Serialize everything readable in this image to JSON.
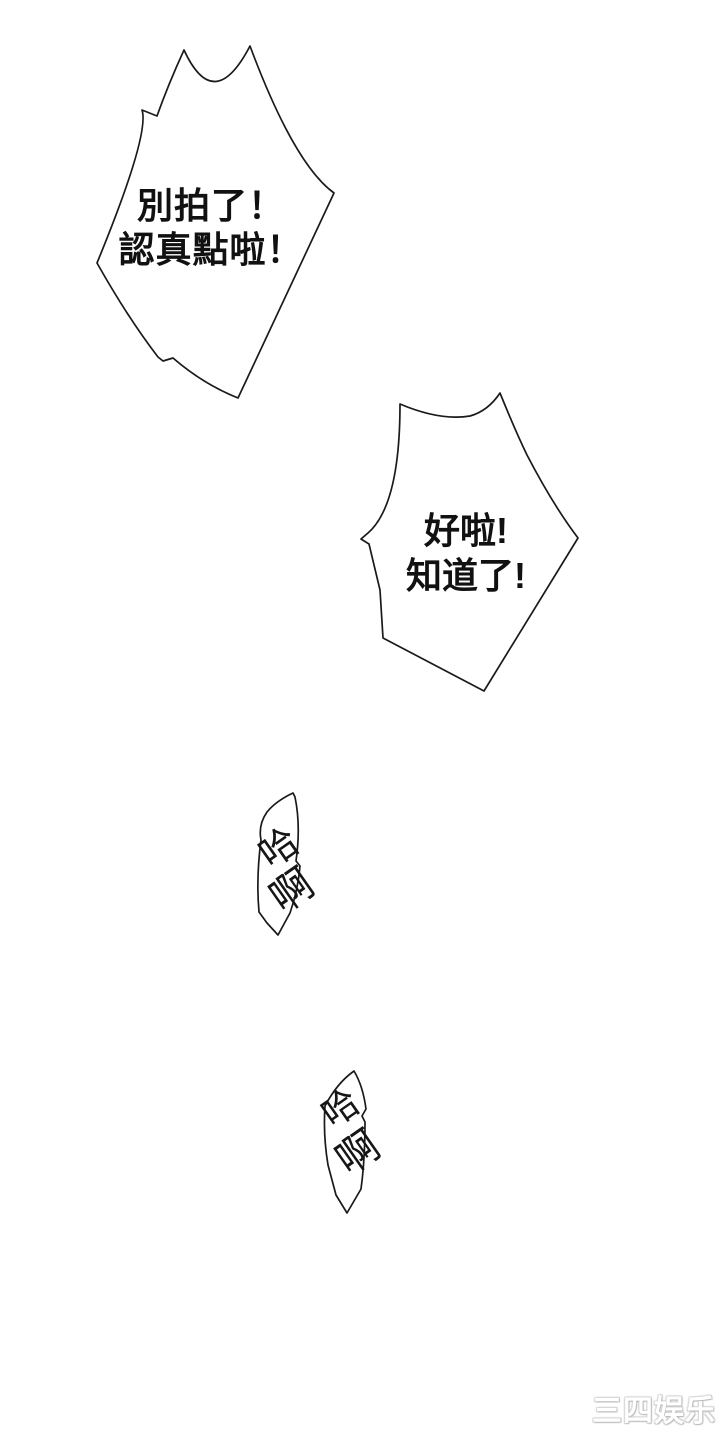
{
  "colors": {
    "background": "#ffffff",
    "ink": "#1a1a1a",
    "watermark_fill": "#ffffff",
    "watermark_shadow": "#c0c0c0"
  },
  "bubbles": {
    "shout": {
      "line1": "別拍了！",
      "line2": "認真點啦！"
    },
    "reply": {
      "line1": "好啦!",
      "line2": "知道了!"
    },
    "sfx1": {
      "char1": "哈",
      "char2": "啊"
    },
    "sfx2": {
      "char1": "哈",
      "char2": "啊"
    }
  },
  "watermark": {
    "text": "三四娱乐"
  }
}
